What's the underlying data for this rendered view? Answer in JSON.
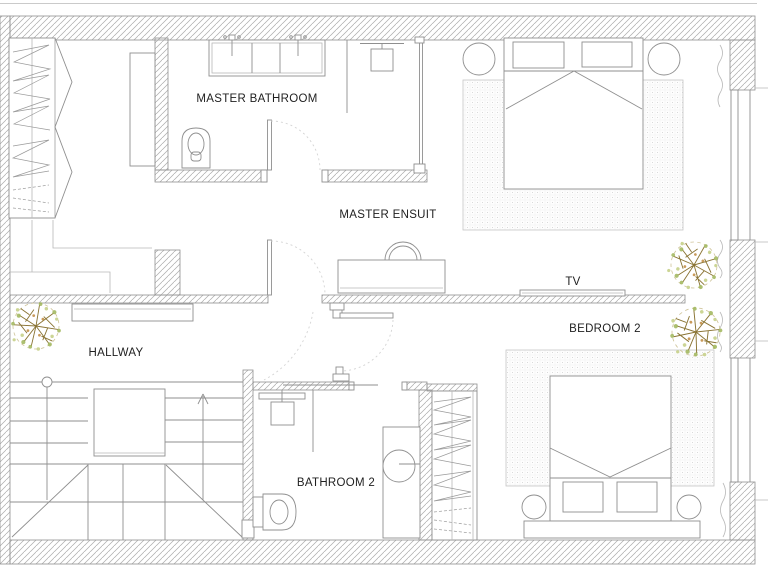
{
  "labels": {
    "master_bathroom": "MASTER BATHROOM",
    "master_ensuite": "MASTER ENSUIT",
    "tv": "TV",
    "bedroom_2": "BEDROOM 2",
    "hallway": "HALLWAY",
    "bathroom_2": "BATHROOM 2"
  },
  "colors": {
    "line": "#8f8f8f",
    "hatch": "#ababab",
    "faint": "#d4d4d4",
    "text": "#1f1f1f",
    "plant_branch": "#8a7434",
    "plant_leaf": "#9fb558",
    "plant_leaf2": "#c6d08a",
    "plant_accent": "#c08a3e"
  }
}
